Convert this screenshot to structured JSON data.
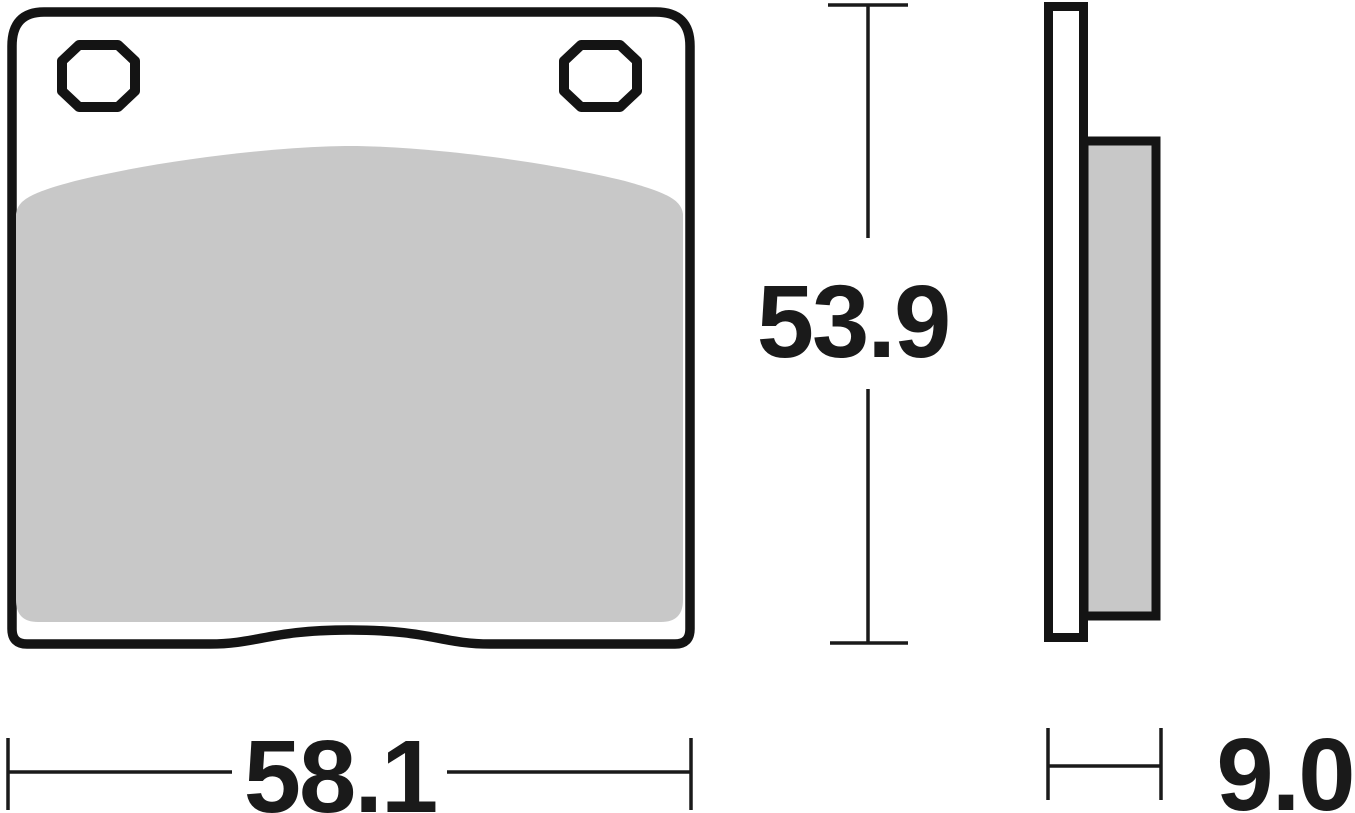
{
  "drawing": {
    "dimensions": {
      "width": {
        "label": "58.1"
      },
      "height": {
        "label": "53.9"
      },
      "thickness": {
        "label": "9.0"
      }
    },
    "colors": {
      "outline": "#141414",
      "friction": "#c8c8c8",
      "plate_fill": "#ffffff",
      "dimension_line": "#1a1a1a",
      "label_text": "#1a1a1a",
      "background": "#ffffff"
    }
  }
}
